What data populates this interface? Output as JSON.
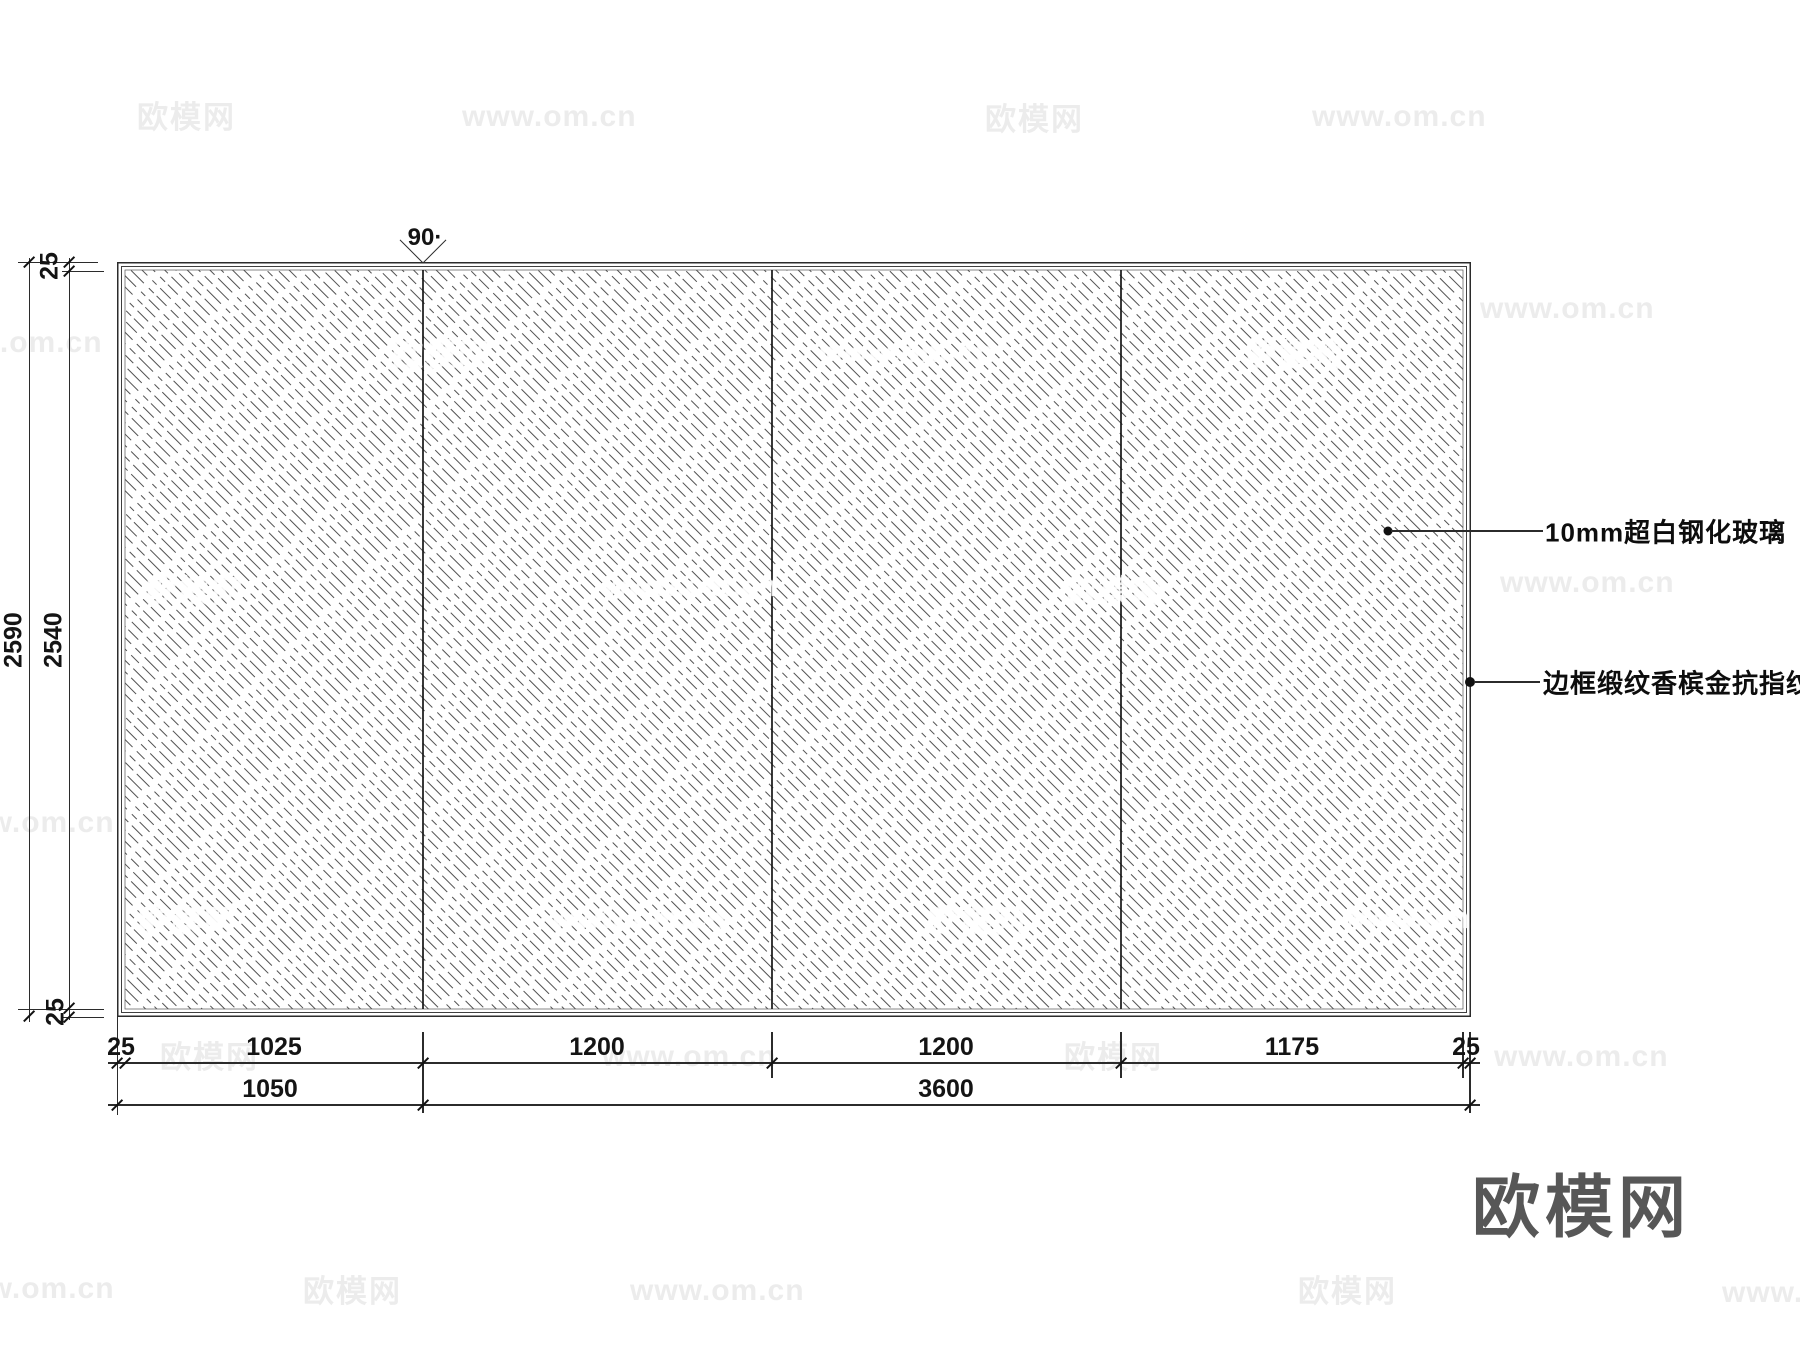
{
  "drawing": {
    "type": "glass-partition-elevation",
    "panel_count": 4,
    "hatch_style": "diagonal-dashed-45deg",
    "line_color": "#2b2b2b"
  },
  "annotations": {
    "angle_label": "90·",
    "glass_label": "10mm超白钢化玻璃",
    "frame_label": "边框缎纹香槟金抗指纹"
  },
  "dims": {
    "v_overall": "2590",
    "v_glass": "2540",
    "v_top": "25",
    "v_bottom": "25",
    "b1": [
      "25",
      "1025",
      "1200",
      "1200",
      "1175",
      "25"
    ],
    "b2": [
      "1050",
      "3600"
    ]
  },
  "watermarks": {
    "brand": "欧模网",
    "site": "www.om.cn",
    "items": [
      {
        "t": "brand",
        "x": 137,
        "y": 92,
        "v": "gray"
      },
      {
        "t": "site",
        "x": 462,
        "y": 100,
        "v": "gray"
      },
      {
        "t": "brand",
        "x": 985,
        "y": 94,
        "v": "gray"
      },
      {
        "t": "site",
        "x": 1312,
        "y": 100,
        "v": "gray"
      },
      {
        "t": "site",
        "x": -72,
        "y": 326,
        "v": "gray"
      },
      {
        "t": "brand",
        "x": 392,
        "y": 330,
        "v": "white"
      },
      {
        "t": "site",
        "x": 820,
        "y": 336,
        "v": "white"
      },
      {
        "t": "brand",
        "x": 1246,
        "y": 330,
        "v": "white"
      },
      {
        "t": "site",
        "x": 1480,
        "y": 292,
        "v": "gray"
      },
      {
        "t": "brand",
        "x": 146,
        "y": 566,
        "v": "white"
      },
      {
        "t": "site",
        "x": 604,
        "y": 570,
        "v": "white"
      },
      {
        "t": "brand",
        "x": 1066,
        "y": 566,
        "v": "white"
      },
      {
        "t": "site",
        "x": 1500,
        "y": 566,
        "v": "gray"
      },
      {
        "t": "site",
        "x": -60,
        "y": 806,
        "v": "gray"
      },
      {
        "t": "brand",
        "x": 138,
        "y": 896,
        "v": "white"
      },
      {
        "t": "site",
        "x": 552,
        "y": 902,
        "v": "white"
      },
      {
        "t": "brand",
        "x": 928,
        "y": 896,
        "v": "white"
      },
      {
        "t": "site",
        "x": 1342,
        "y": 902,
        "v": "white"
      },
      {
        "t": "brand",
        "x": 160,
        "y": 1032,
        "v": "gray"
      },
      {
        "t": "site",
        "x": 602,
        "y": 1040,
        "v": "gray"
      },
      {
        "t": "brand",
        "x": 1064,
        "y": 1032,
        "v": "gray"
      },
      {
        "t": "site",
        "x": 1494,
        "y": 1040,
        "v": "gray"
      },
      {
        "t": "site",
        "x": -60,
        "y": 1272,
        "v": "gray"
      },
      {
        "t": "brand",
        "x": 303,
        "y": 1266,
        "v": "gray"
      },
      {
        "t": "site",
        "x": 630,
        "y": 1274,
        "v": "gray"
      },
      {
        "t": "brand",
        "x": 1298,
        "y": 1266,
        "v": "gray"
      },
      {
        "t": "site",
        "x": 1722,
        "y": 1276,
        "v": "gray"
      }
    ]
  },
  "logo": {
    "text": "欧模网"
  }
}
